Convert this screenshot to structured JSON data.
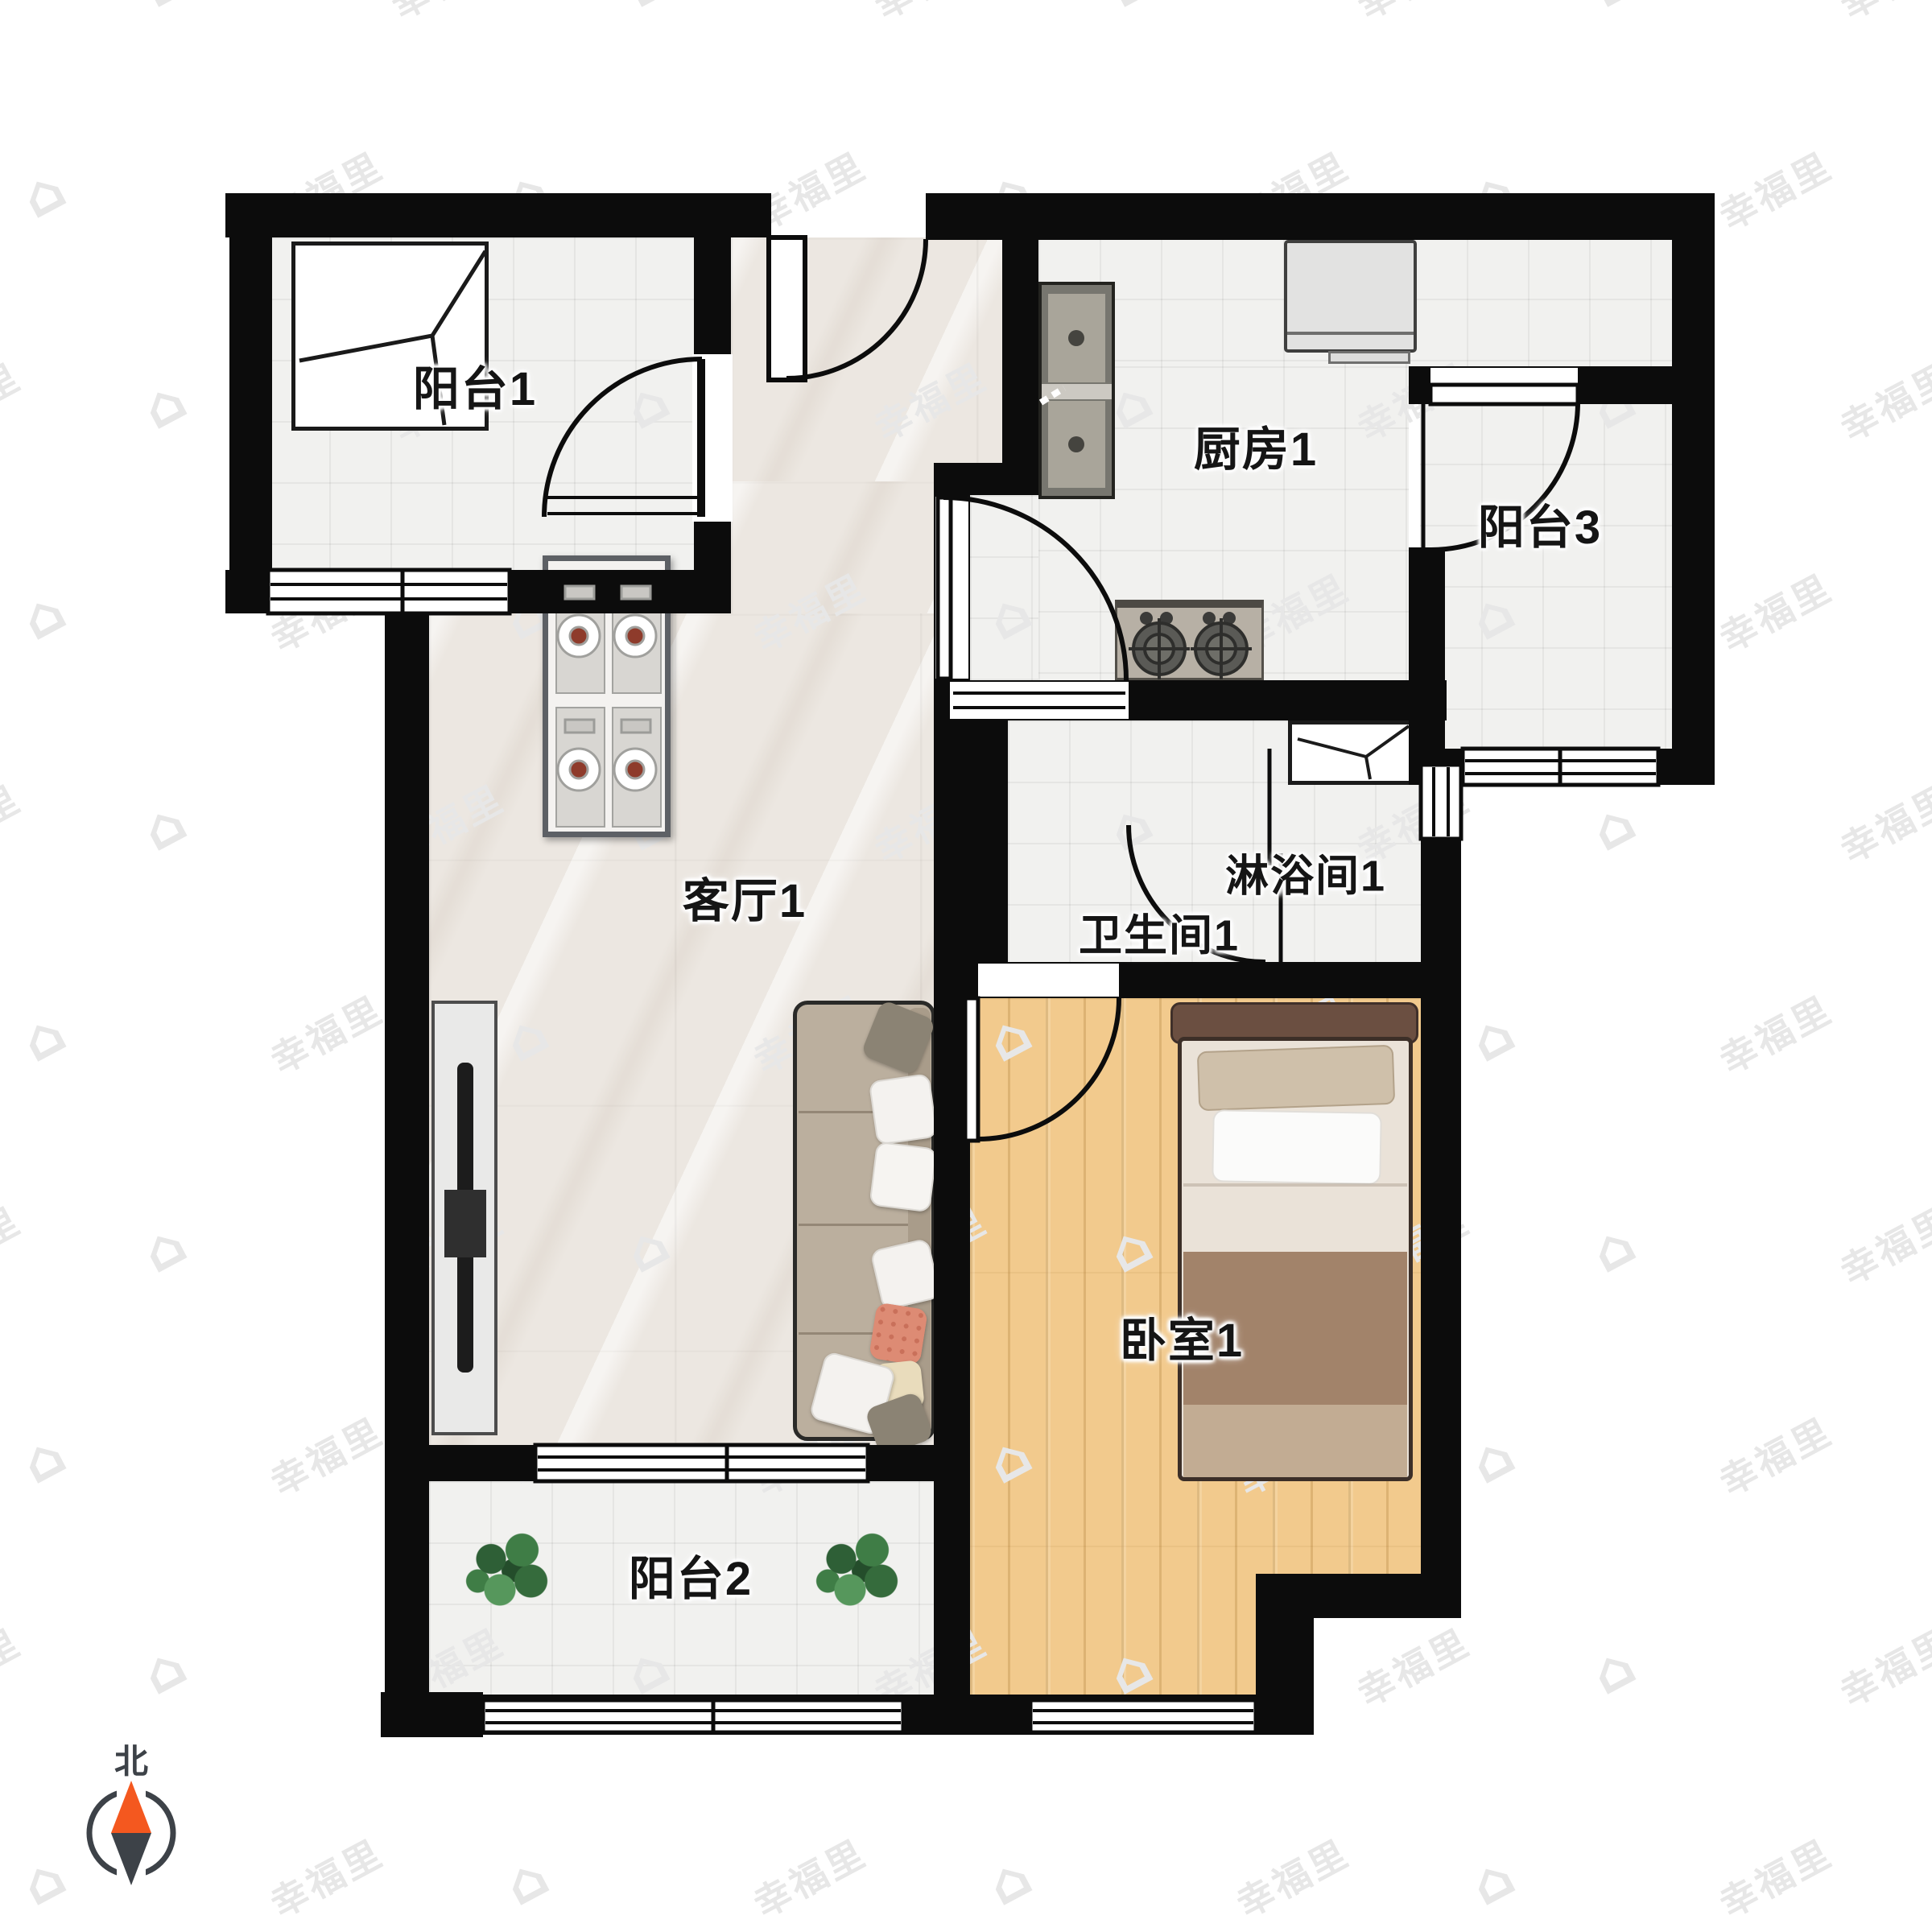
{
  "rooms": [
    {
      "id": "balcony1",
      "label": "阳台1"
    },
    {
      "id": "kitchen1",
      "label": "厨房1"
    },
    {
      "id": "balcony3",
      "label": "阳台3"
    },
    {
      "id": "living1",
      "label": "客厅1"
    },
    {
      "id": "shower1",
      "label": "淋浴间1"
    },
    {
      "id": "bath1",
      "label": "卫生间1"
    },
    {
      "id": "bedroom1",
      "label": "卧室1"
    },
    {
      "id": "balcony2",
      "label": "阳台2"
    }
  ],
  "compass": {
    "label": "北",
    "north_color": "#f4581f",
    "south_color": "#3d4248"
  },
  "watermark": {
    "text": "幸福里",
    "icon": "house-icon",
    "icon_glyph": "⌂",
    "color": "#e7e7e7"
  },
  "colors": {
    "wall": "#0c0c0c",
    "tile_floor": "#f1f1ef",
    "marble_floor": "#ece7e1",
    "wood_floor": "#f2ca8d",
    "sofa": "#bbaf9e",
    "bed_blanket": "#a2836a",
    "plant": "#3f7d46",
    "accent_coral": "#dd8b74"
  }
}
